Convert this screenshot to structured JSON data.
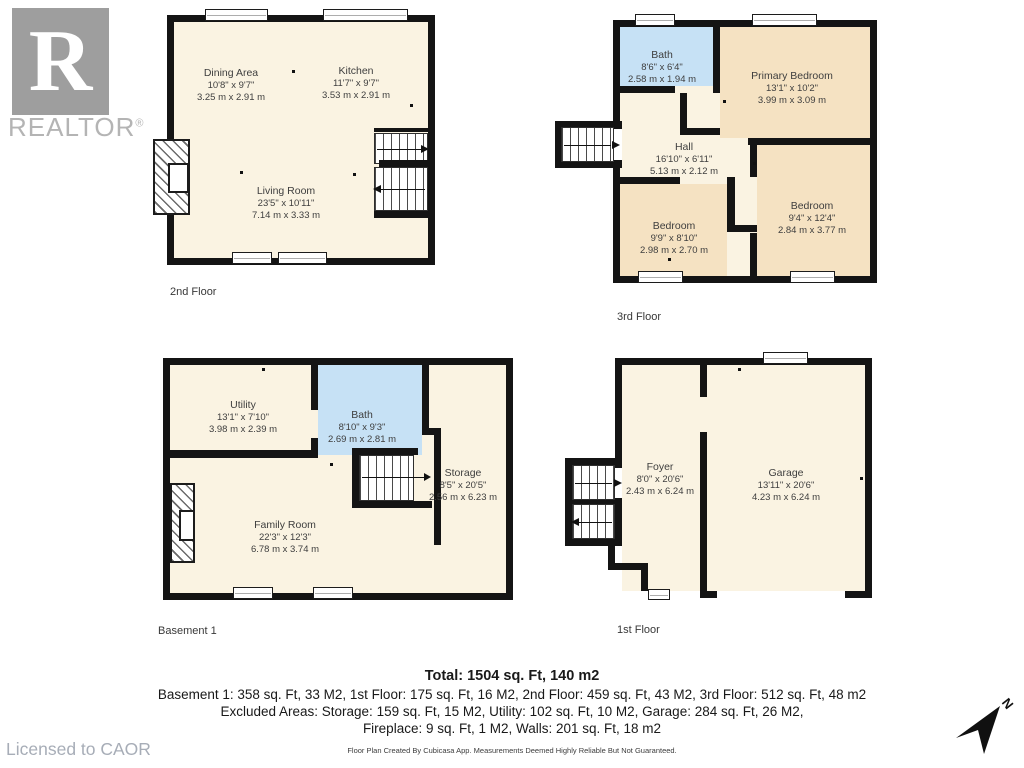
{
  "branding": {
    "logo_letter": "R",
    "logo_text": "REALTOR",
    "registered_mark": "®",
    "licensed_text": "Licensed to CAOR"
  },
  "floors": {
    "second": {
      "label": "2nd Floor",
      "rooms": {
        "dining": {
          "name": "Dining Area",
          "imperial": "10'8\" x 9'7\"",
          "metric": "3.25 m x 2.91 m"
        },
        "kitchen": {
          "name": "Kitchen",
          "imperial": "11'7\" x 9'7\"",
          "metric": "3.53 m x 2.91 m"
        },
        "living": {
          "name": "Living Room",
          "imperial": "23'5\" x 10'11\"",
          "metric": "7.14 m x 3.33 m"
        }
      }
    },
    "third": {
      "label": "3rd Floor",
      "rooms": {
        "bath": {
          "name": "Bath",
          "imperial": "8'6\" x 6'4\"",
          "metric": "2.58 m x 1.94 m"
        },
        "primary": {
          "name": "Primary Bedroom",
          "imperial": "13'1\" x 10'2\"",
          "metric": "3.99 m x 3.09 m"
        },
        "hall": {
          "name": "Hall",
          "imperial": "16'10\" x 6'11\"",
          "metric": "5.13 m x 2.12 m"
        },
        "bedroom_left": {
          "name": "Bedroom",
          "imperial": "9'9\" x 8'10\"",
          "metric": "2.98 m x 2.70 m"
        },
        "bedroom_right": {
          "name": "Bedroom",
          "imperial": "9'4\" x 12'4\"",
          "metric": "2.84 m x 3.77 m"
        }
      }
    },
    "basement": {
      "label": "Basement 1",
      "rooms": {
        "utility": {
          "name": "Utility",
          "imperial": "13'1\" x 7'10\"",
          "metric": "3.98 m x 2.39 m"
        },
        "bath": {
          "name": "Bath",
          "imperial": "8'10\" x 9'3\"",
          "metric": "2.69 m x 2.81 m"
        },
        "storage": {
          "name": "Storage",
          "imperial": "8'5\" x 20'5\"",
          "metric": "2.56 m x 6.23 m"
        },
        "family": {
          "name": "Family Room",
          "imperial": "22'3\" x 12'3\"",
          "metric": "6.78 m x 3.74 m"
        }
      }
    },
    "first": {
      "label": "1st Floor",
      "rooms": {
        "foyer": {
          "name": "Foyer",
          "imperial": "8'0\" x 20'6\"",
          "metric": "2.43 m x 6.24 m"
        },
        "garage": {
          "name": "Garage",
          "imperial": "13'11\" x 20'6\"",
          "metric": "4.23 m x 6.24 m"
        }
      }
    }
  },
  "summary": {
    "total": "Total: 1504 sq. Ft, 140 m2",
    "line1": "Basement 1: 358 sq. Ft, 33 M2, 1st Floor: 175 sq. Ft, 16 M2, 2nd Floor: 459 sq. Ft, 43 M2, 3rd Floor: 512 sq. Ft, 48 m2",
    "line2": "Excluded Areas: Storage: 159 sq. Ft, 15 M2, Utility: 102 sq. Ft, 10 M2, Garage: 284 sq. Ft, 26 M2,",
    "line3": "Fireplace: 9 sq. Ft, 1 M2, Walls: 201 sq. Ft, 18 m2",
    "disclaimer": "Floor Plan Created By Cubicasa App. Measurements Deemed Highly Reliable But Not Guaranteed."
  },
  "compass": {
    "north_label": "N"
  },
  "colors": {
    "wall": "#141414",
    "floor": "#FAF3E2",
    "tan": "#F5E2C2",
    "blue": "#C6E1F5",
    "logo_gray": "#9E9E9E",
    "logo_text_gray": "#B4B4B4"
  }
}
